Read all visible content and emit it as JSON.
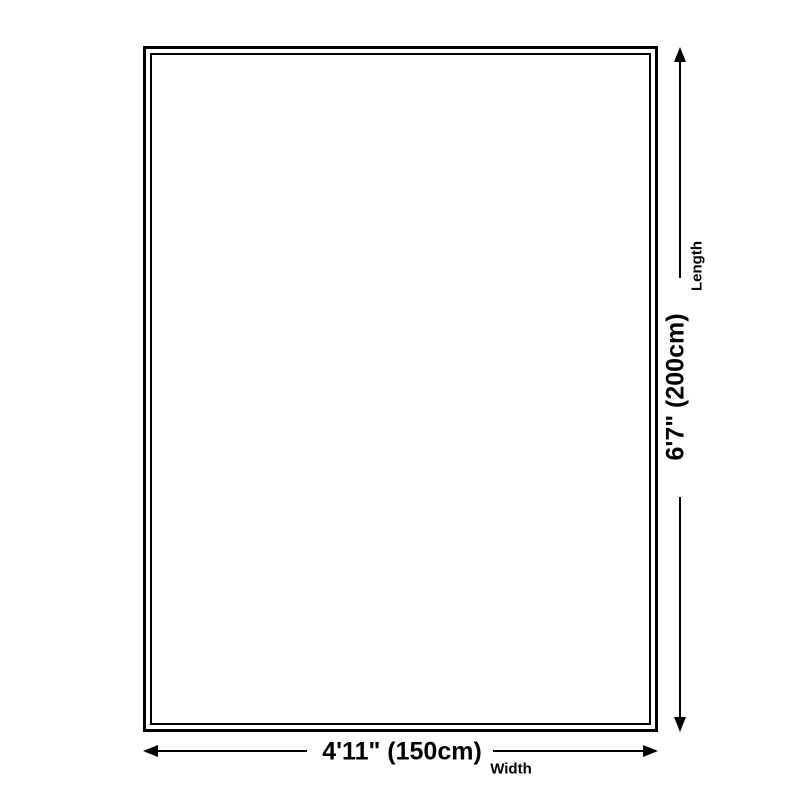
{
  "page": {
    "background_color": "#ffffff",
    "line_color": "#000000"
  },
  "diagram": {
    "type": "product-size-guide",
    "shape": "rectangle",
    "rectangle": {
      "border_style": "double-line",
      "fill_color": "#ffffff"
    },
    "length_dimension": {
      "value": "6'7\" (200cm)",
      "label": "Length",
      "orientation": "vertical",
      "arrow_icons": [
        "arrow-up-icon",
        "arrow-down-icon"
      ]
    },
    "width_dimension": {
      "value": "4'11\" (150cm)",
      "label": "Width",
      "orientation": "horizontal",
      "arrow_icons": [
        "arrow-left-icon",
        "arrow-right-icon"
      ]
    }
  }
}
